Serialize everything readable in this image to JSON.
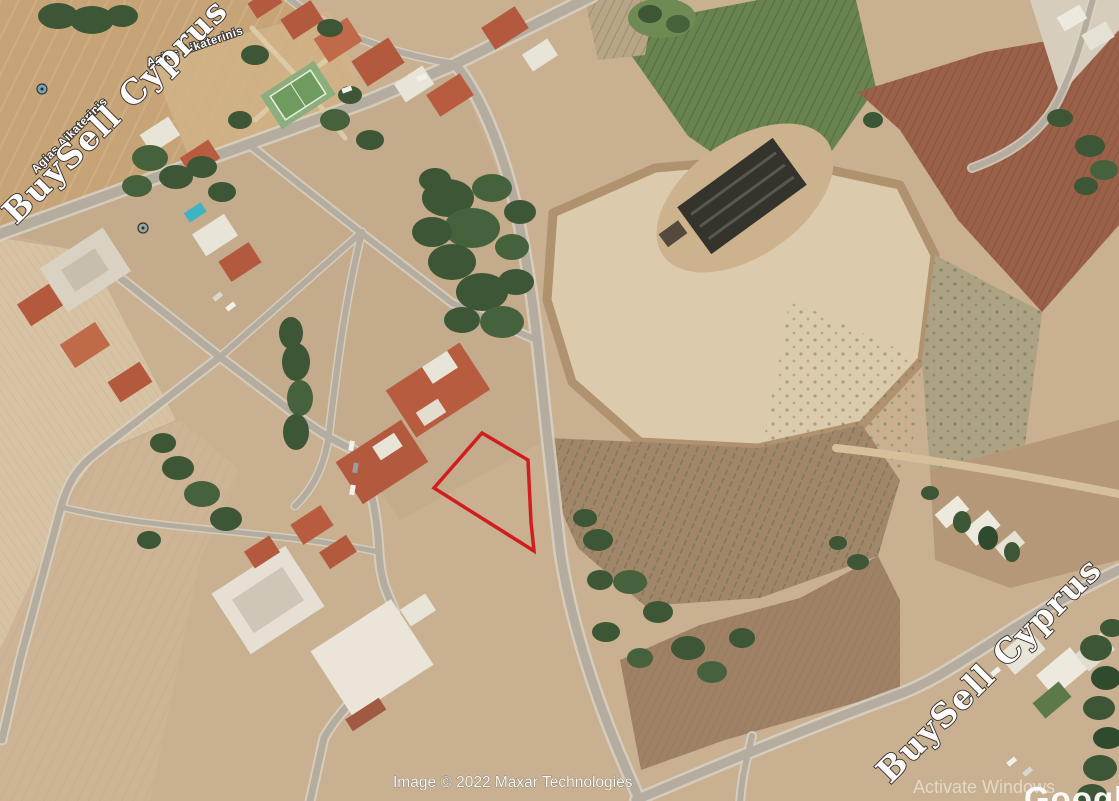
{
  "branding": {
    "watermark_text": "BuySell Cyprus",
    "watermark_color": "#ffffff"
  },
  "street_labels": {
    "label_1": "Agias Aikaterinis",
    "label_2": "Agias Aikaterinis"
  },
  "attribution": {
    "imagery_credit": "Image © 2022 Maxar Technologies",
    "logo_partial": "Google"
  },
  "system_overlay": {
    "activate_windows": "Activate Windows"
  },
  "plot_highlight": {
    "outline_color": "#d01e1e",
    "points": "482,433 528,460 531,522 534,551 434,488"
  }
}
